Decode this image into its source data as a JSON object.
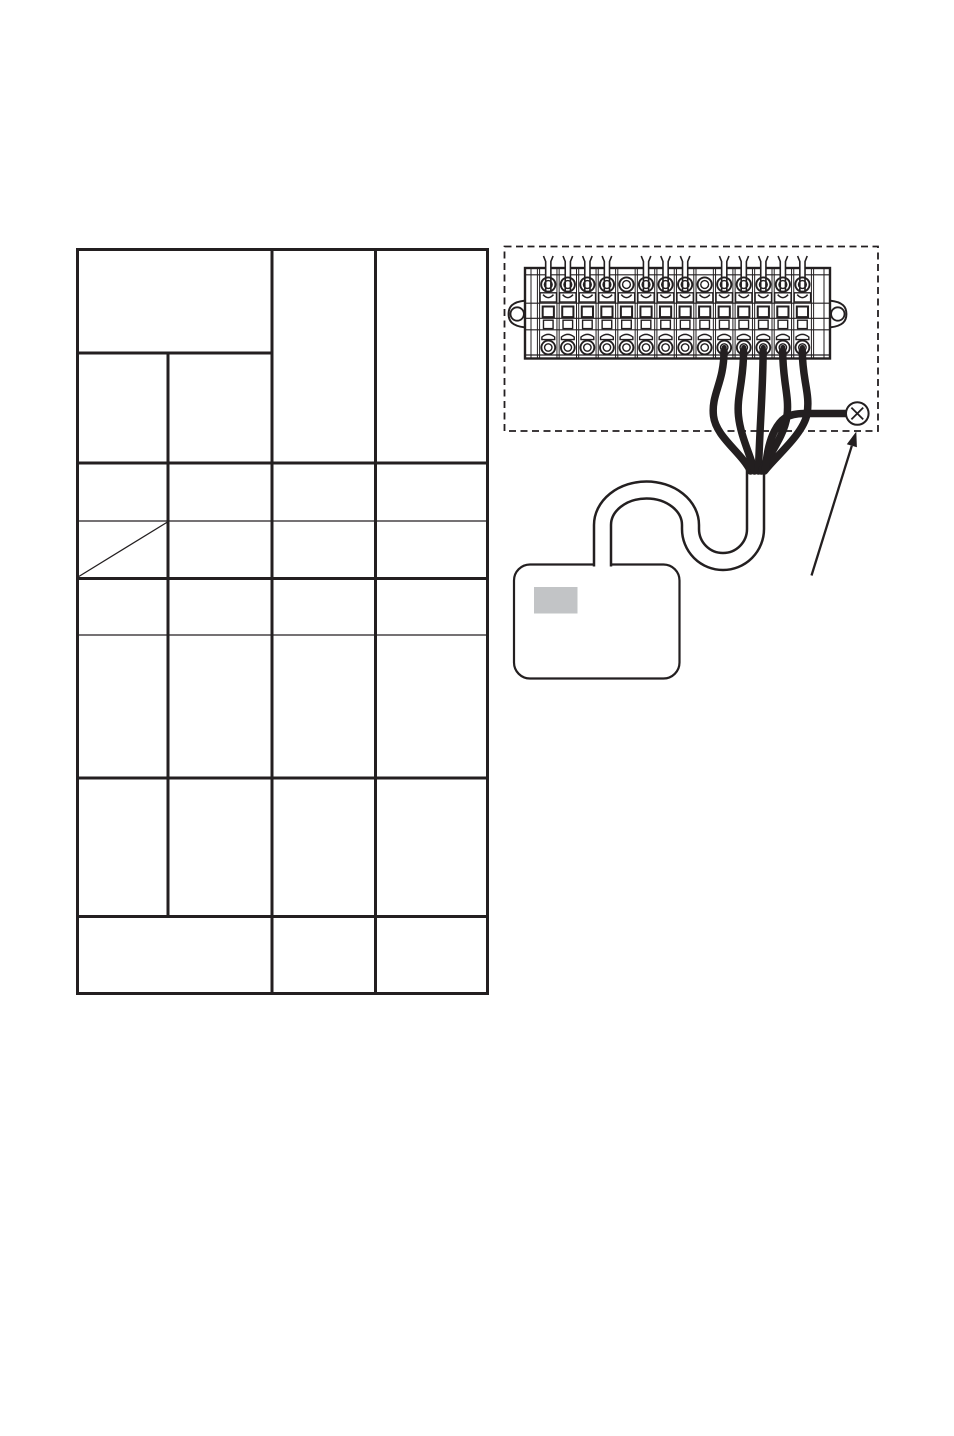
{
  "page": {
    "width": 954,
    "height": 1436,
    "background": "#ffffff",
    "visible_text": ""
  },
  "colors": {
    "ink": "#231f20",
    "paper": "#ffffff",
    "device_label_gray": "#c2c4c6"
  },
  "table": {
    "description": "empty specification table, no text in any cell",
    "bounds": {
      "x": 76,
      "y": 248,
      "width": 413,
      "height": 747
    },
    "line_weights": {
      "thick": 3,
      "thin": 1.2
    },
    "h_lines": [
      {
        "y": 249.5,
        "x1": 76,
        "x2": 489,
        "w": "thick"
      },
      {
        "y": 353,
        "x1": 76,
        "x2": 272,
        "w": "thick"
      },
      {
        "y": 463,
        "x1": 76,
        "x2": 489,
        "w": "thick"
      },
      {
        "y": 521,
        "x1": 76,
        "x2": 489,
        "w": "thin"
      },
      {
        "y": 578.5,
        "x1": 76,
        "x2": 489,
        "w": "thick"
      },
      {
        "y": 635,
        "x1": 76,
        "x2": 489,
        "w": "thin"
      },
      {
        "y": 778,
        "x1": 76,
        "x2": 489,
        "w": "thick"
      },
      {
        "y": 916.5,
        "x1": 76,
        "x2": 489,
        "w": "thick"
      },
      {
        "y": 993.5,
        "x1": 76,
        "x2": 489,
        "w": "thick"
      }
    ],
    "v_lines": [
      {
        "x": 77.5,
        "y1": 248,
        "y2": 995,
        "w": "thick"
      },
      {
        "x": 168,
        "y1": 353,
        "y2": 916.5,
        "w": "thick"
      },
      {
        "x": 272,
        "y1": 248,
        "y2": 995,
        "w": "thick"
      },
      {
        "x": 375.5,
        "y1": 248,
        "y2": 995,
        "w": "thick"
      },
      {
        "x": 487.5,
        "y1": 248,
        "y2": 995,
        "w": "thick"
      }
    ],
    "diagonal": {
      "x1": 78,
      "y1": 577,
      "x2": 167.5,
      "y2": 522,
      "w": 1.3
    }
  },
  "diagram": {
    "dashed_box": {
      "x": 504.5,
      "y": 246.5,
      "width": 373.5,
      "height": 184.5,
      "dash": "7 4.5",
      "stroke_w": 1.8
    },
    "terminal_block": {
      "x": 525,
      "y": 268,
      "width": 305,
      "height": 90.5,
      "stroke_w": 2.4,
      "columns": 14,
      "col_start": 538.5,
      "col_pitch": 19.55,
      "top_wired_columns": [
        1,
        2,
        3,
        4,
        6,
        7,
        8,
        10,
        11,
        12,
        13,
        14
      ],
      "bottom_wired_columns": [
        10,
        11,
        12,
        13,
        14
      ],
      "screw_top_cy": 284.5,
      "screw_bottom_cy": 347.5,
      "screw_outer_r": 7.1,
      "screw_inner_r": 3.9,
      "wired_dot_r": 2.6,
      "rails_y": [
        274.8,
        303.2,
        318.3,
        329.8,
        355
      ],
      "end_plate_lines_x": [
        531,
        537.4,
        539.6,
        811.4,
        813.6,
        824
      ],
      "ears": {
        "cy": 314,
        "hole_r": 6.7,
        "left_hole_cx": 517.2,
        "right_hole_cx": 837.8
      }
    },
    "cable": {
      "path": "M 755.5 464 L 755.5 529 A 32.5 32.5 0 0 1 690.5 529 L 690.5 525 A 44 35 0 0 0 602.5 525 L 602.5 566.5",
      "outer_w": 19.5,
      "inner_w": 14.5
    },
    "wire_stroke_w": 7.5,
    "wires": [
      "M 724 351 C 724 383 711 394 713.5 416 C 716 437 741 452 750.5 471",
      "M 743.6 351 C 743.6 382 736.5 396 738.5 416 C 740.5 436 750 454 754.5 471",
      "M 763.1 351 C 763.1 388 759.5 430 758.5 471",
      "M 782.7 351 C 782.7 382 789.5 396 787 416 C 784.5 436 768 456 761.5 471",
      "M 802.3 351 C 802.3 380 810.5 394 807 414 C 803.5 434 775 457 764.5 471",
      "M 846 413.5 L 804 413.5 C 787 413.5 780.5 419.5 774.5 431 C 768.5 442.5 766.5 456 765.5 469"
    ],
    "device": {
      "x": 514,
      "y": 564.5,
      "width": 165.5,
      "height": 114,
      "radius": 16,
      "stroke_w": 2.2,
      "label": {
        "x": 534,
        "y": 587,
        "width": 43.5,
        "height": 26.5
      }
    },
    "clamp_marker": {
      "cx": 857.3,
      "cy": 413.5,
      "r": 11.3,
      "x_half": 5.9,
      "stroke_w": 2
    },
    "arrow": {
      "x1": 811.5,
      "y1": 575.5,
      "x2": 851.8,
      "y2": 445.8,
      "stroke_w": 2.3,
      "head_points": "856.3,431.5 856.9,447.3 846.8,444.2"
    }
  }
}
